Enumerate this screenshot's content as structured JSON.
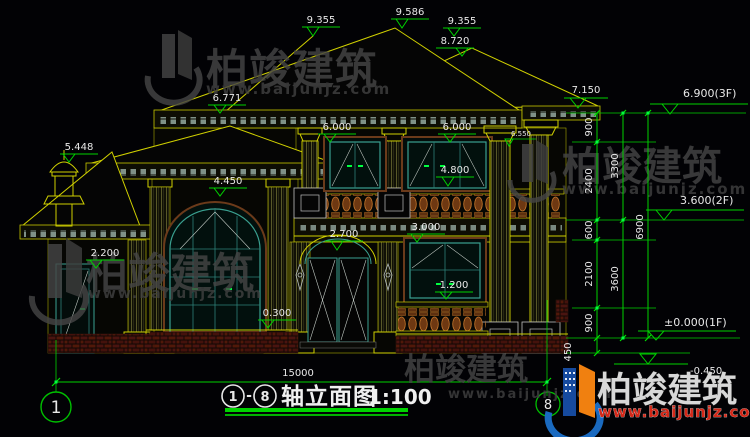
{
  "colors": {
    "background": "#020205",
    "line_yellow": "#d0d000",
    "dim_green": "#00d200",
    "text_white": "#e8e8e8",
    "frame_teal": "#3aa090",
    "casing_brown": "#6b3a1a",
    "baluster_orange": "#c8782c",
    "brick_red": "#4a1410",
    "watermark_gray": "#454545",
    "watermark_red": "#d42818",
    "logo_blue": "#1a6ac0",
    "logo_orange": "#f08010"
  },
  "watermark": {
    "name": "柏竣建筑",
    "url": "www.baijunjz.com"
  },
  "title": {
    "axis_start": "1",
    "separator": "-",
    "axis_end": "8",
    "name": "轴立面图",
    "scale": "1:100"
  },
  "axis": {
    "left_bubble": "1",
    "right_bubble": "8"
  },
  "elevation_labels": {
    "ridge_left": "9.355",
    "ridge_peak": "9.586",
    "ridge_right": "9.355",
    "ridge_lower": "8.720",
    "eave_main": "6.771",
    "eave_right": "7.150",
    "turret_top": "5.448",
    "win2f_head_left": "6.000",
    "win2f_head_right": "6.000",
    "capital_right": "6.550",
    "win2f_sill": "4.800",
    "porch_eave": "4.450",
    "door_head": "2.700",
    "win1f_head": "3.000",
    "win1f_sill": "1.200",
    "annex_door_head": "2.200",
    "plinth_top": "0.300"
  },
  "floor_levels": {
    "f3": "6.900(3F)",
    "f2": "3.600(2F)",
    "f1": "±0.000(1F)",
    "grade": "-0.450"
  },
  "vertical_dims": {
    "seg1": "900",
    "seg2": "2400",
    "seg3": "600",
    "seg4": "2100",
    "seg5": "900",
    "seg6": "450",
    "sub1": "3300",
    "sub2": "3600",
    "total": "6900"
  },
  "horizontal_dims": {
    "total": "15000"
  }
}
